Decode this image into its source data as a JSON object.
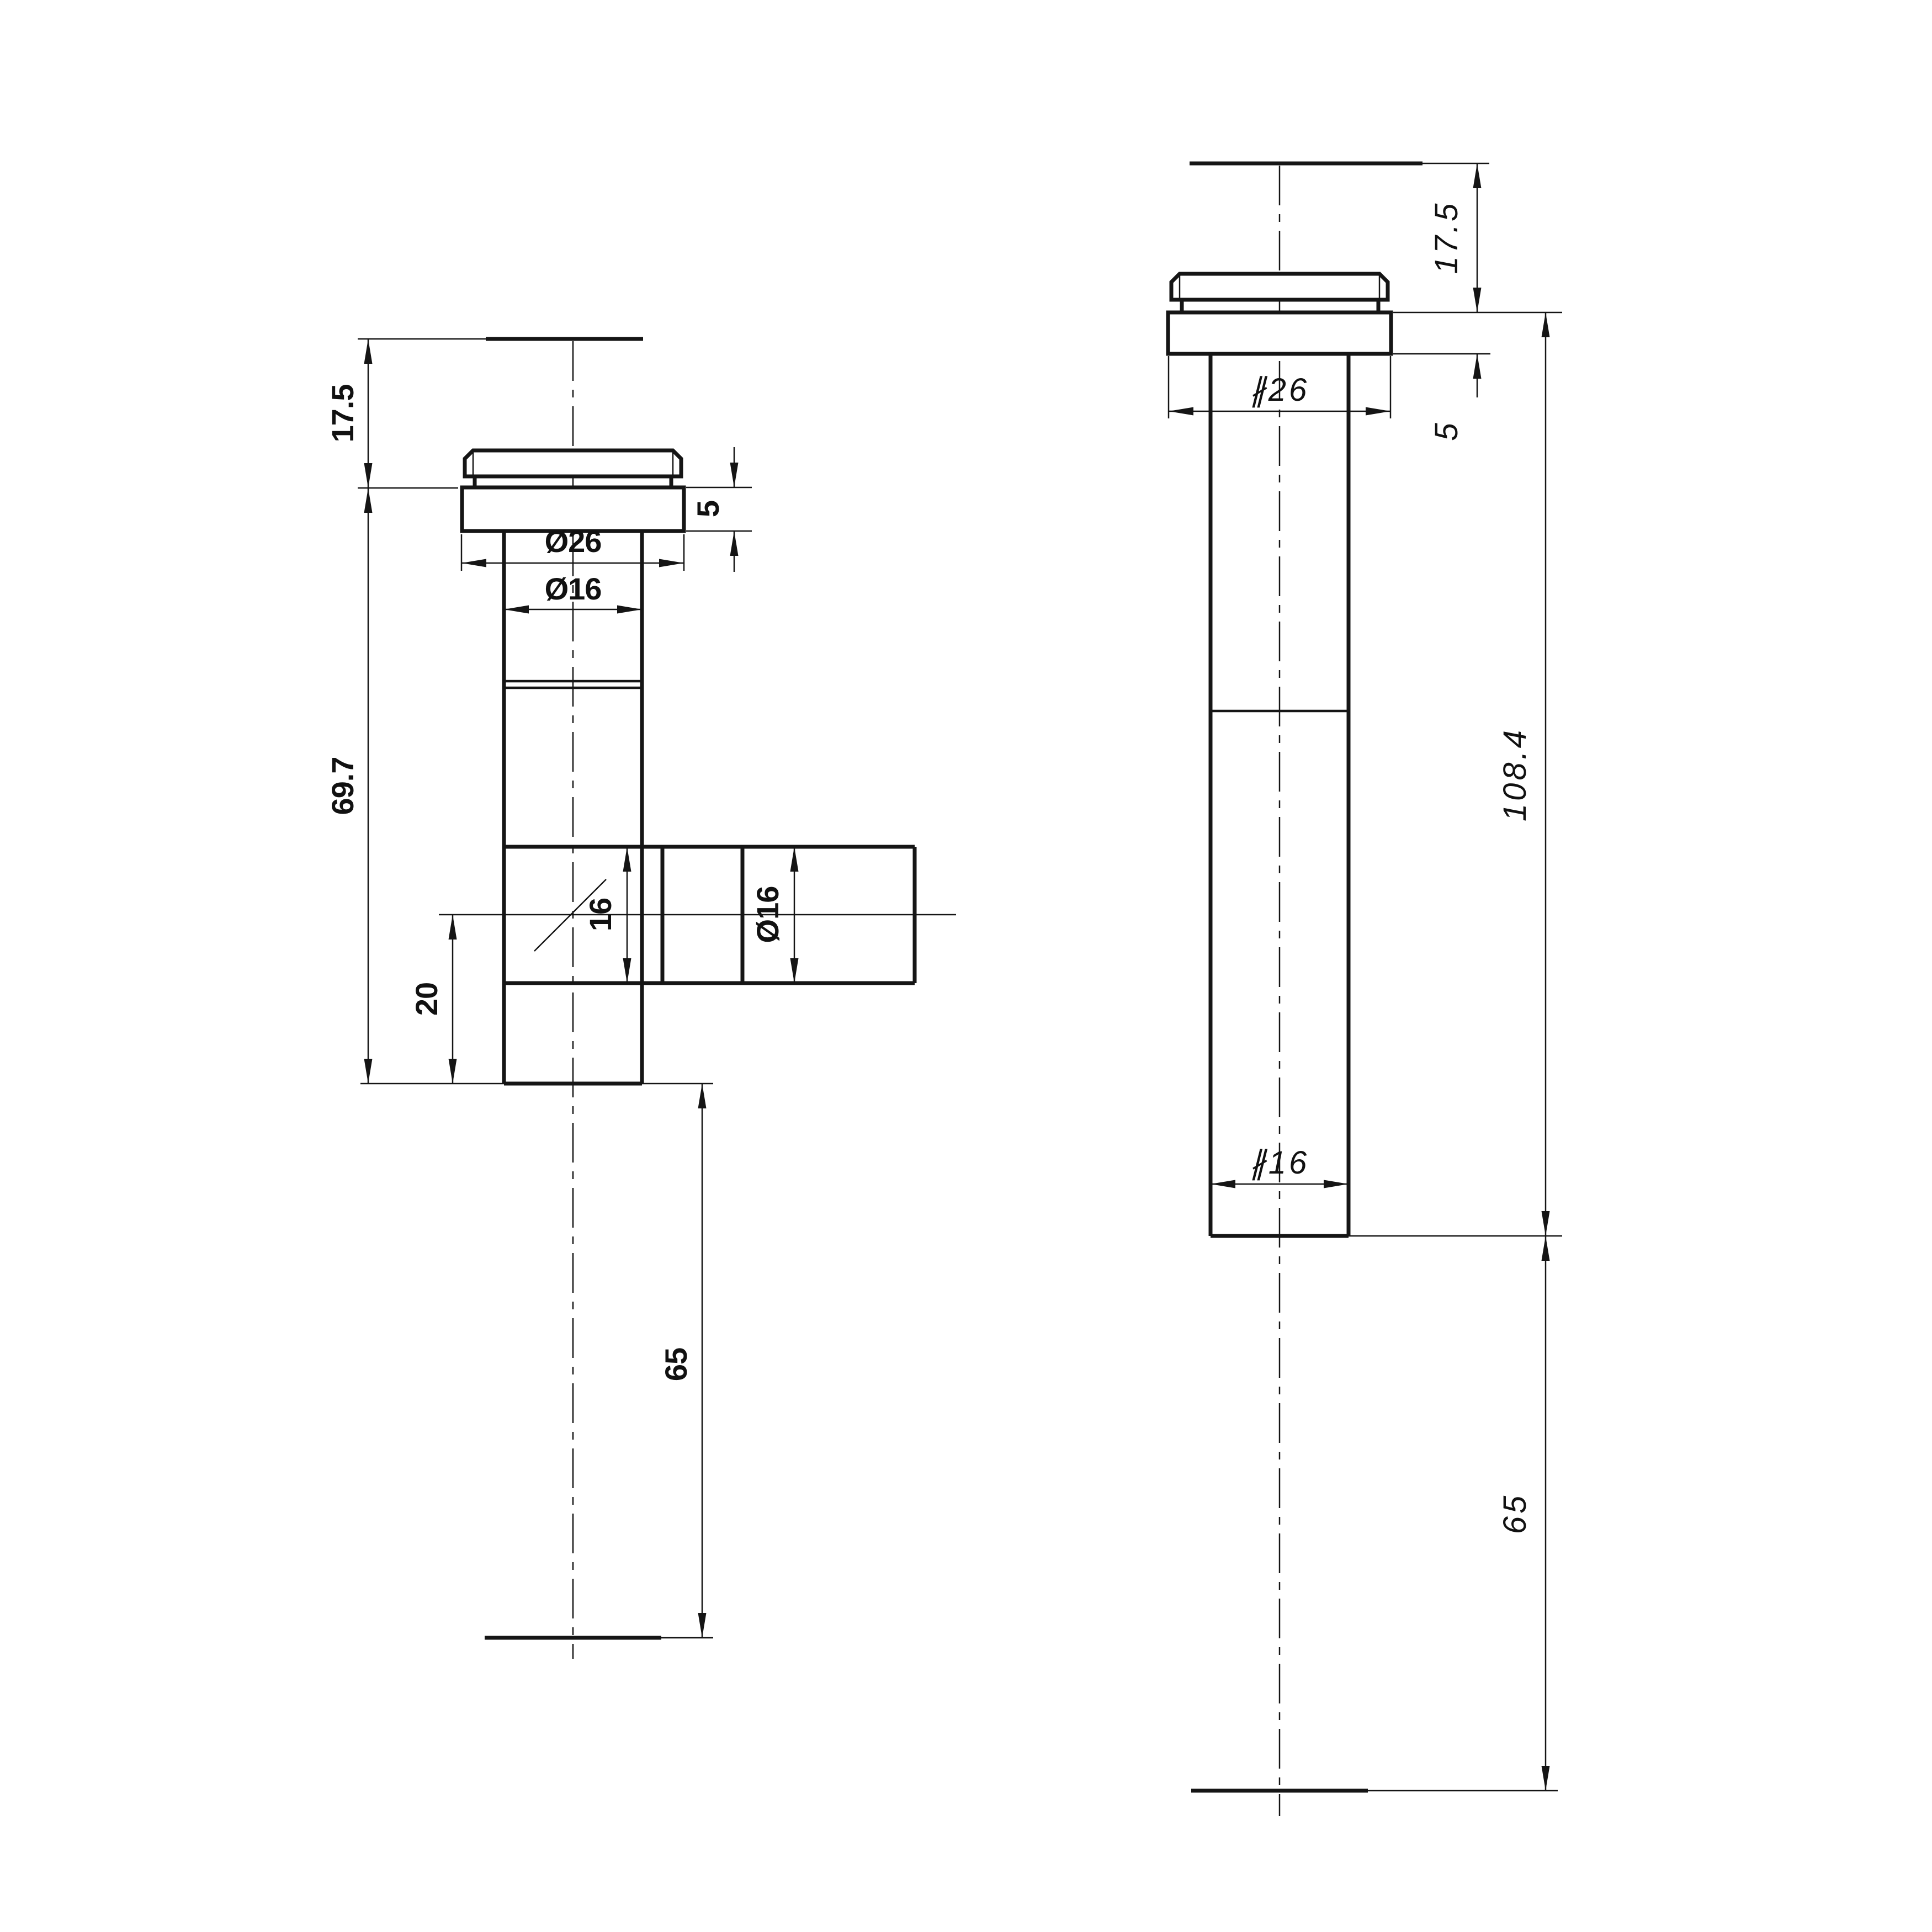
{
  "drawing": {
    "type": "technical-orthographic-drawing",
    "background_color": "#ffffff",
    "line_color": "#151515",
    "views": [
      {
        "id": "tee-outlet-view",
        "position": "left",
        "dims": {
          "top_height": "17.5",
          "flange_thickness": "5",
          "flange_diameter": "Ø26",
          "tube_diameter": "Ø16",
          "body_length": "69.7",
          "branch_bore": "16",
          "branch_diameter": "Ø16",
          "branch_offset": "20",
          "tail_length": "65"
        }
      },
      {
        "id": "straight-outlet-view",
        "position": "right",
        "dims": {
          "top_height": "17.5",
          "flange_thickness": "5",
          "flange_diameter": "∦26",
          "body_length": "108.4",
          "tube_diameter": "∦16",
          "tail_length": "65"
        }
      }
    ]
  }
}
